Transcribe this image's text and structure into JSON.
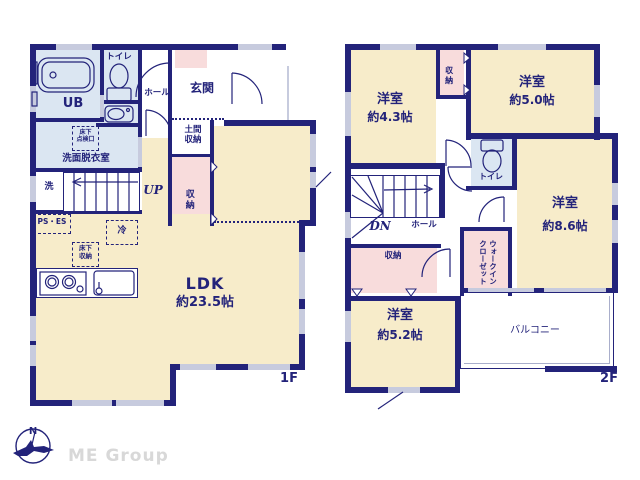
{
  "meta": {
    "brand": "ME Group"
  },
  "compass": {
    "north_label": "N"
  },
  "colors": {
    "wall": "#23237a",
    "room_cream": "#f7ecca",
    "room_blue": "#dbe6f2",
    "room_pink": "#f8dcdc",
    "window": "#c7cbde",
    "brand_gray": "#d8d8d8"
  },
  "floor1": {
    "floor_label": "1F",
    "rooms": {
      "ldk": {
        "name": "LDK",
        "size": "約23.5帖"
      },
      "bath": {
        "name": "UB"
      },
      "toilet": {
        "name": "トイレ"
      },
      "hall": {
        "name": "ホール"
      },
      "entrance": {
        "name": "玄関"
      },
      "entrance_storage": {
        "name": "土間\n収納"
      },
      "closet": {
        "name": "収納"
      },
      "washroom": {
        "name": "洗面脱衣室"
      },
      "laundry": {
        "name": "洗"
      }
    },
    "annotations": {
      "underfloor_access": "床下\n点検口",
      "underfloor_storage": "床下\n収納",
      "pipe_space": "PS・ES",
      "refrigerator": "冷",
      "stairs_up": "UP"
    }
  },
  "floor2": {
    "floor_label": "2F",
    "rooms": {
      "bedroom_a": {
        "name": "洋室",
        "size": "約4.3帖"
      },
      "bedroom_b": {
        "name": "洋室",
        "size": "約5.0帖"
      },
      "bedroom_c": {
        "name": "洋室",
        "size": "約8.6帖"
      },
      "bedroom_d": {
        "name": "洋室",
        "size": "約5.2帖"
      },
      "closet_a": {
        "name": "収納"
      },
      "closet_b": {
        "name": "収納"
      },
      "walk_in_closet": {
        "name": "ウォークインクローゼット",
        "line1": "ウォークイン",
        "line2": "クローゼット"
      },
      "toilet": {
        "name": "トイレ"
      },
      "hall": {
        "name": "ホール"
      },
      "balcony": {
        "name": "バルコニー"
      }
    },
    "annotations": {
      "stairs_down": "DN"
    }
  }
}
